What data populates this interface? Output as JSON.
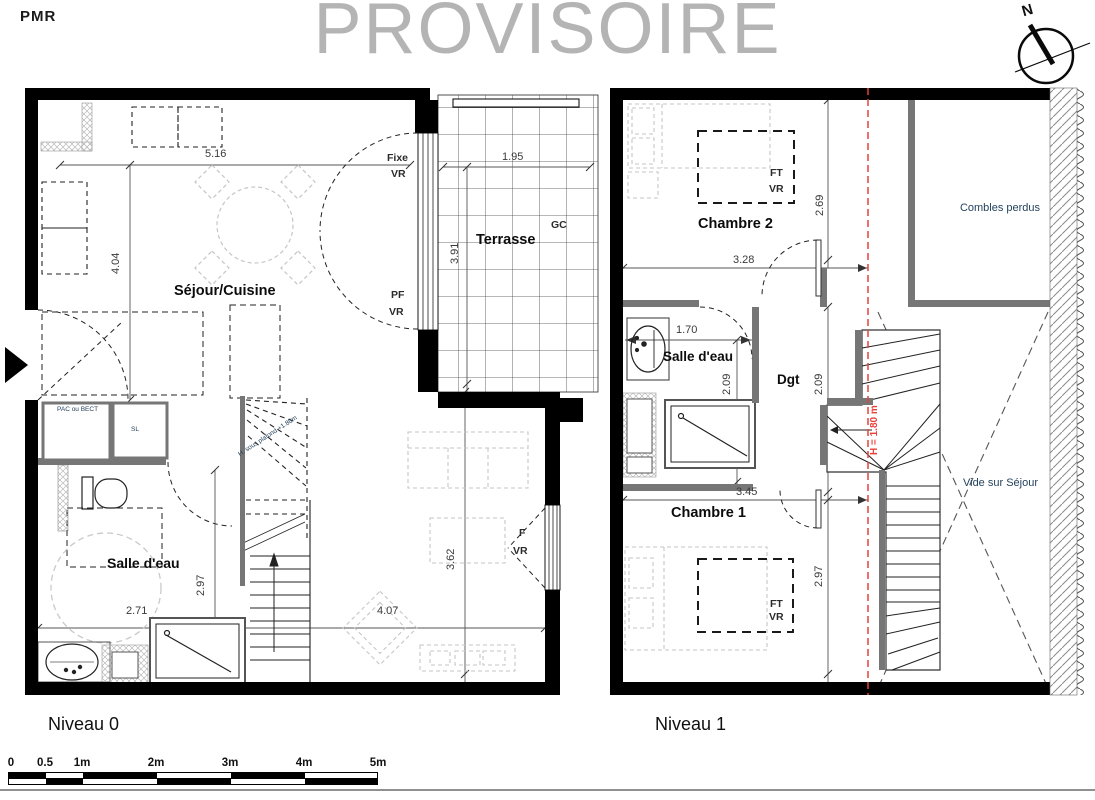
{
  "header": {
    "pmr": "PMR",
    "watermark": "PROVISOIRE",
    "compass_n": "N"
  },
  "level0": {
    "title": "Niveau 0",
    "rooms": {
      "sejour": "Séjour/Cuisine",
      "terrasse": "Terrasse",
      "salle_eau": "Salle d'eau"
    },
    "openings": {
      "fixe": "Fixe",
      "fixe_vr": "VR",
      "pf": "PF",
      "pf_vr": "VR",
      "f": "F",
      "f_vr": "VR",
      "gc": "GC"
    },
    "closets": {
      "pac": "PAC\nou\nBECT",
      "sl": "SL"
    },
    "stair_note": "H. sous plafond\n+1.80m",
    "dims": {
      "sejour_w": "5.16",
      "sejour_h": "4.04",
      "terrasse_w": "1.95",
      "terrasse_h": "3.91",
      "salle_w": "2.71",
      "salle_h": "2.97",
      "living_w": "4.07",
      "living_h": "3.62"
    }
  },
  "level1": {
    "title": "Niveau 1",
    "rooms": {
      "chambre2": "Chambre 2",
      "chambre1": "Chambre 1",
      "salle_eau": "Salle d'eau",
      "dgt": "Dgt",
      "combles": "Combles\nperdus",
      "vide": "Vide sur\nSéjour"
    },
    "openings": {
      "ft2": "FT",
      "ft2_vr": "VR",
      "ft1": "FT",
      "ft1_vr": "VR"
    },
    "height_note": "H = 1.80 m",
    "dims": {
      "chambre2_h": "2.69",
      "chambre2_w": "3.28",
      "salle_w": "1.70",
      "salle_h": "2.09",
      "dgt_h": "2.09",
      "chambre1_w": "3.45",
      "chambre1_h": "2.97"
    }
  },
  "scalebar": {
    "ticks": [
      "0",
      "0.5",
      "1m",
      "2m",
      "3m",
      "4m",
      "5m"
    ]
  },
  "colors": {
    "wall": "#000000",
    "partition": "#767676",
    "furniture_gray": "#c6c6c6",
    "red": "#e8403a",
    "navy": "#24425e",
    "watermark": "#b4b4b4"
  }
}
